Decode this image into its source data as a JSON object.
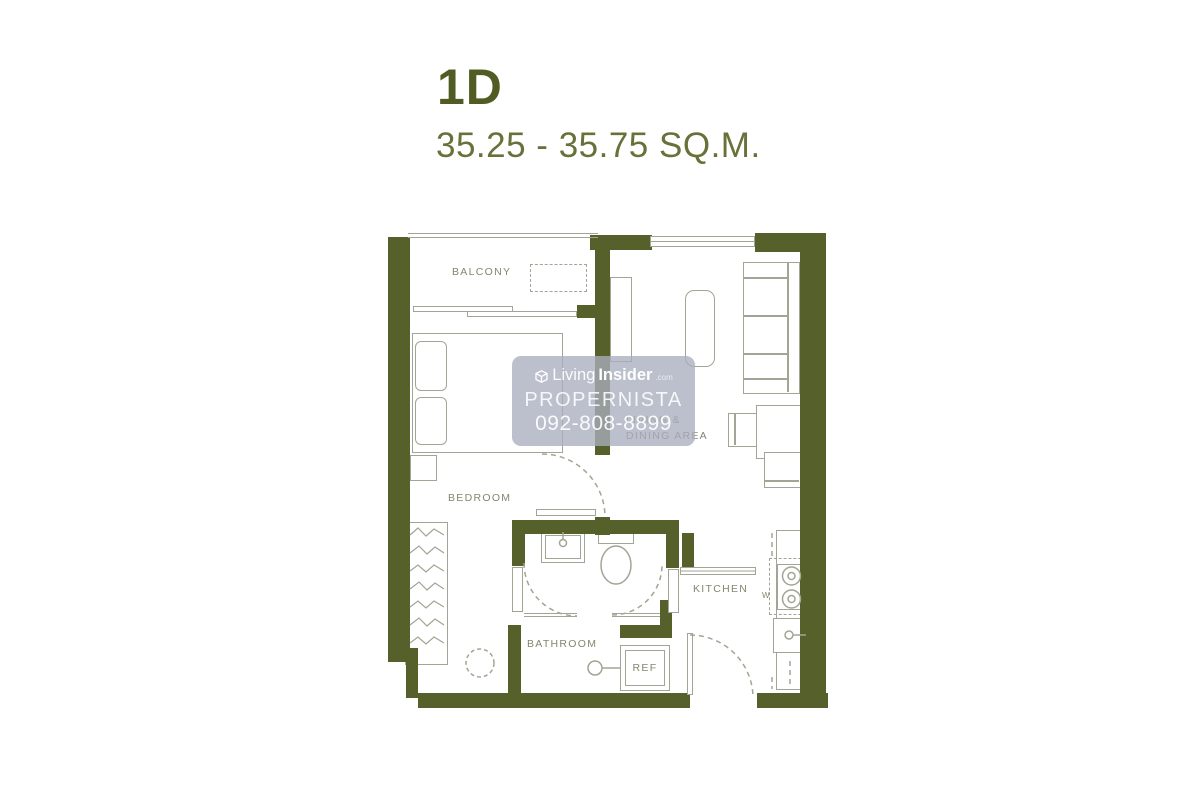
{
  "header": {
    "unit_type": "1D",
    "area_range": "35.25 - 35.75 SQ.M."
  },
  "floorplan": {
    "labels": {
      "balcony": "BALCONY",
      "bedroom": "BEDROOM",
      "living_line1": "LIVING &",
      "living_line2": "DINING AREA",
      "bathroom": "BATHROOM",
      "kitchen": "KITCHEN",
      "refrigerator": "REF",
      "washer_marker": "W"
    },
    "colors": {
      "wall": "#56602a",
      "furniture_line": "#a2a593",
      "label_text": "#84866e",
      "title": "#515c24",
      "subtitle": "#68713a"
    }
  },
  "watermark": {
    "brand_light": "Living",
    "brand_bold": "Insider",
    "brand_suffix": ".com",
    "name": "PROPERNISTA",
    "phone": "092-808-8899",
    "background": "#a8acbd"
  }
}
